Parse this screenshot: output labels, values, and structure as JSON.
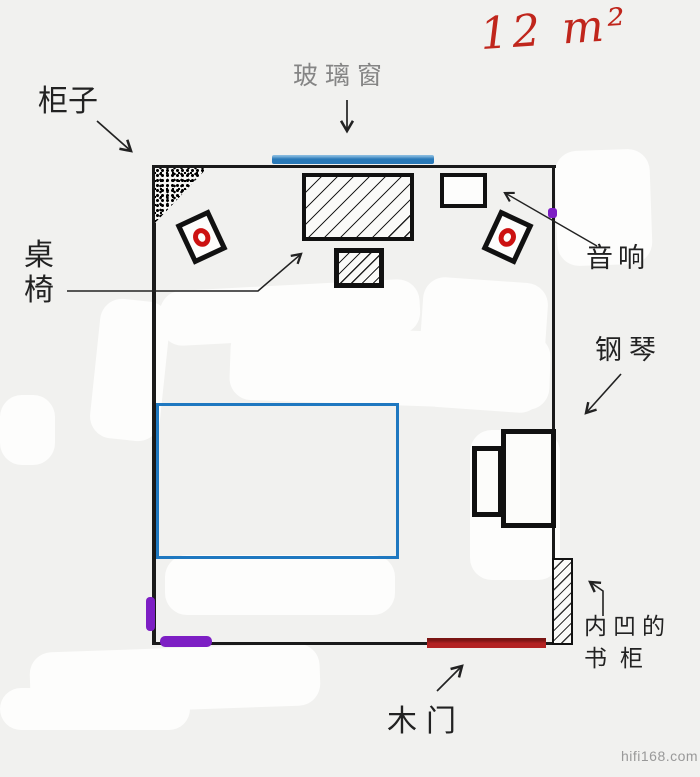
{
  "area": {
    "text": "12 m²"
  },
  "labels": {
    "cabinet": "柜子",
    "glass_window": "玻璃窗",
    "table_chair_char1": "桌",
    "table_chair_char2": "椅",
    "audio": "音响",
    "piano": "钢琴",
    "recessed_bookcase_line1": "内凹的",
    "recessed_bookcase_line2": "书柜",
    "wooden_door": "木门"
  },
  "watermark": "hifi168.com",
  "icons": {
    "speaker_symbol": "red-ring-in-tilted-square",
    "cabinet_symbol": "speckled-corner-triangle",
    "table_symbol": "diagonal-hatched-rectangle",
    "bookcase_symbol": "hatched-wall-strip"
  },
  "colors": {
    "wall_black": "#1a1a1a",
    "window_blue": "#2979b8",
    "door_red": "#b32222",
    "bed_outline_blue": "#1f78c0",
    "area_text_red": "#c0261c",
    "speaker_ring_red": "#cc1111",
    "purple_marks": "#7d1fc4",
    "window_label_gray": "#858585",
    "watermark_gray": "#999999"
  }
}
